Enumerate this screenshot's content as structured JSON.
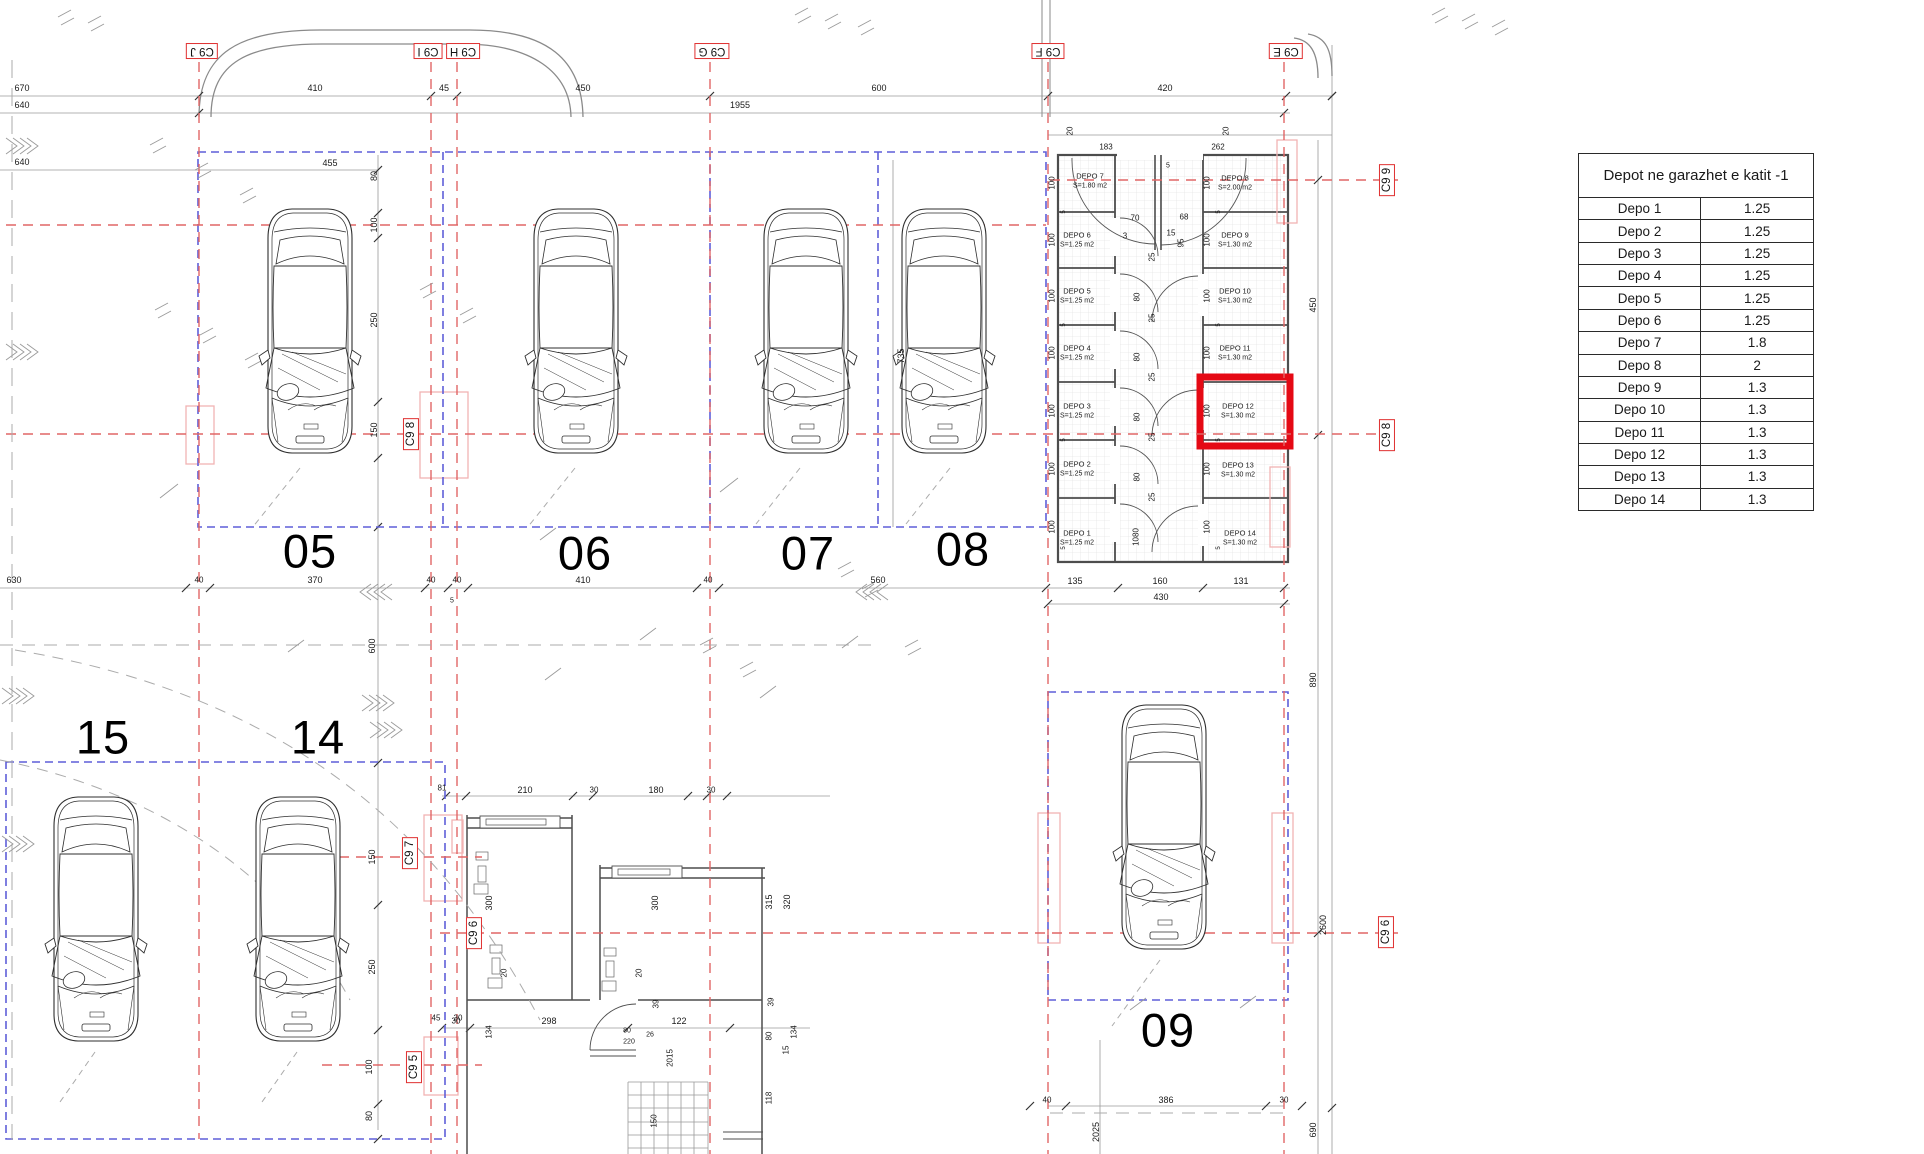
{
  "table": {
    "title": "Depot ne garazhet e katit -1",
    "rows": [
      {
        "name": "Depo 1",
        "value": "1.25"
      },
      {
        "name": "Depo 2",
        "value": "1.25"
      },
      {
        "name": "Depo 3",
        "value": "1.25"
      },
      {
        "name": "Depo 4",
        "value": "1.25"
      },
      {
        "name": "Depo 5",
        "value": "1.25"
      },
      {
        "name": "Depo 6",
        "value": "1.25"
      },
      {
        "name": "Depo 7",
        "value": "1.8"
      },
      {
        "name": "Depo 8",
        "value": "2"
      },
      {
        "name": "Depo 9",
        "value": "1.3"
      },
      {
        "name": "Depo 10",
        "value": "1.3"
      },
      {
        "name": "Depo 11",
        "value": "1.3"
      },
      {
        "name": "Depo 12",
        "value": "1.3"
      },
      {
        "name": "Depo 13",
        "value": "1.3"
      },
      {
        "name": "Depo 14",
        "value": "1.3"
      }
    ]
  },
  "grid_markers": [
    {
      "t": "C9 J",
      "x": 202,
      "y": 51,
      "r": 180
    },
    {
      "t": "C9 I",
      "x": 428,
      "y": 51,
      "r": 180
    },
    {
      "t": "C9 H",
      "x": 463,
      "y": 51,
      "r": 180
    },
    {
      "t": "C9 G",
      "x": 712,
      "y": 51,
      "r": 180
    },
    {
      "t": "C9 F",
      "x": 1048,
      "y": 51,
      "r": 180
    },
    {
      "t": "C9 E",
      "x": 1286,
      "y": 51,
      "r": 180
    },
    {
      "t": "C9 9",
      "x": 1387,
      "y": 180,
      "r": -90
    },
    {
      "t": "C9 8",
      "x": 411,
      "y": 434,
      "r": -90
    },
    {
      "t": "C9 8",
      "x": 1387,
      "y": 435,
      "r": -90
    },
    {
      "t": "C9 7",
      "x": 410,
      "y": 853,
      "r": -90
    },
    {
      "t": "C9 6",
      "x": 474,
      "y": 933,
      "r": -90
    },
    {
      "t": "C9 6",
      "x": 1386,
      "y": 932,
      "r": -90
    },
    {
      "t": "C9 5",
      "x": 414,
      "y": 1067,
      "r": -90
    }
  ],
  "stalls": [
    {
      "t": "05",
      "x": 310,
      "y": 551
    },
    {
      "t": "06",
      "x": 585,
      "y": 553
    },
    {
      "t": "07",
      "x": 808,
      "y": 553
    },
    {
      "t": "08",
      "x": 963,
      "y": 549
    },
    {
      "t": "09",
      "x": 1168,
      "y": 1030
    },
    {
      "t": "15",
      "x": 103,
      "y": 737
    },
    {
      "t": "14",
      "x": 318,
      "y": 737
    }
  ],
  "depots": [
    {
      "name": "DEPO 7",
      "area": "S=1.80 m2",
      "x": 1090,
      "y": 181
    },
    {
      "name": "DEPO 6",
      "area": "S=1.25 m2",
      "x": 1077,
      "y": 240
    },
    {
      "name": "DEPO 5",
      "area": "S=1.25 m2",
      "x": 1077,
      "y": 296
    },
    {
      "name": "DEPO 4",
      "area": "S=1.25 m2",
      "x": 1077,
      "y": 353
    },
    {
      "name": "DEPO 3",
      "area": "S=1.25 m2",
      "x": 1077,
      "y": 411
    },
    {
      "name": "DEPO 2",
      "area": "S=1.25 m2",
      "x": 1077,
      "y": 469
    },
    {
      "name": "DEPO 1",
      "area": "S=1.25 m2",
      "x": 1077,
      "y": 538
    },
    {
      "name": "DEPO 8",
      "area": "S=2.00 m2",
      "x": 1235,
      "y": 183
    },
    {
      "name": "DEPO 9",
      "area": "S=1.30 m2",
      "x": 1235,
      "y": 240
    },
    {
      "name": "DEPO 10",
      "area": "S=1.30 m2",
      "x": 1235,
      "y": 296
    },
    {
      "name": "DEPO 11",
      "area": "S=1.30 m2",
      "x": 1235,
      "y": 353
    },
    {
      "name": "DEPO 12",
      "area": "S=1.30 m2",
      "x": 1238,
      "y": 411
    },
    {
      "name": "DEPO 13",
      "area": "S=1.30 m2",
      "x": 1238,
      "y": 470
    },
    {
      "name": "DEPO 14",
      "area": "S=1.30 m2",
      "x": 1240,
      "y": 538
    }
  ],
  "dims": [
    {
      "t": "670",
      "x": 22,
      "y": 88
    },
    {
      "t": "640",
      "x": 22,
      "y": 105
    },
    {
      "t": "640",
      "x": 22,
      "y": 162
    },
    {
      "t": "410",
      "x": 315,
      "y": 88
    },
    {
      "t": "45",
      "x": 444,
      "y": 88
    },
    {
      "t": "450",
      "x": 583,
      "y": 88
    },
    {
      "t": "600",
      "x": 879,
      "y": 88
    },
    {
      "t": "420",
      "x": 1165,
      "y": 88
    },
    {
      "t": "1955",
      "x": 740,
      "y": 105
    },
    {
      "t": "183",
      "x": 1106,
      "y": 147,
      "fs": 8
    },
    {
      "t": "262",
      "x": 1218,
      "y": 147,
      "fs": 8
    },
    {
      "t": "20",
      "x": 1070,
      "y": 131,
      "r": -90,
      "fs": 8
    },
    {
      "t": "20",
      "x": 1226,
      "y": 131,
      "r": -90,
      "fs": 8
    },
    {
      "t": "5",
      "x": 1168,
      "y": 166,
      "fs": 7
    },
    {
      "t": "100",
      "x": 1052,
      "y": 183,
      "r": -90,
      "fs": 8
    },
    {
      "t": "100",
      "x": 1052,
      "y": 240,
      "r": -90,
      "fs": 8
    },
    {
      "t": "100",
      "x": 1052,
      "y": 296,
      "r": -90,
      "fs": 8
    },
    {
      "t": "100",
      "x": 1052,
      "y": 353,
      "r": -90,
      "fs": 8
    },
    {
      "t": "100",
      "x": 1052,
      "y": 411,
      "r": -90,
      "fs": 8
    },
    {
      "t": "100",
      "x": 1052,
      "y": 469,
      "r": -90,
      "fs": 8
    },
    {
      "t": "100",
      "x": 1052,
      "y": 527,
      "r": -90,
      "fs": 8
    },
    {
      "t": "5",
      "x": 1064,
      "y": 212,
      "r": -90,
      "fs": 6
    },
    {
      "t": "5",
      "x": 1064,
      "y": 325,
      "r": -90,
      "fs": 6
    },
    {
      "t": "5",
      "x": 1064,
      "y": 440,
      "r": -90,
      "fs": 6
    },
    {
      "t": "5",
      "x": 1064,
      "y": 548,
      "r": -90,
      "fs": 6
    },
    {
      "t": "100",
      "x": 1207,
      "y": 183,
      "r": -90,
      "fs": 8
    },
    {
      "t": "100",
      "x": 1207,
      "y": 240,
      "r": -90,
      "fs": 8
    },
    {
      "t": "100",
      "x": 1207,
      "y": 296,
      "r": -90,
      "fs": 8
    },
    {
      "t": "100",
      "x": 1207,
      "y": 353,
      "r": -90,
      "fs": 8
    },
    {
      "t": "100",
      "x": 1207,
      "y": 411,
      "r": -90,
      "fs": 8
    },
    {
      "t": "100",
      "x": 1207,
      "y": 469,
      "r": -90,
      "fs": 8
    },
    {
      "t": "100",
      "x": 1207,
      "y": 527,
      "r": -90,
      "fs": 8
    },
    {
      "t": "5",
      "x": 1219,
      "y": 212,
      "r": -90,
      "fs": 6
    },
    {
      "t": "5",
      "x": 1219,
      "y": 325,
      "r": -90,
      "fs": 6
    },
    {
      "t": "5",
      "x": 1219,
      "y": 440,
      "r": -90,
      "fs": 6
    },
    {
      "t": "5",
      "x": 1219,
      "y": 548,
      "r": -90,
      "fs": 6
    },
    {
      "t": "70",
      "x": 1135,
      "y": 218,
      "fs": 8
    },
    {
      "t": "3",
      "x": 1125,
      "y": 236,
      "fs": 8
    },
    {
      "t": "68",
      "x": 1184,
      "y": 217,
      "fs": 8
    },
    {
      "t": "15",
      "x": 1171,
      "y": 233,
      "fs": 8
    },
    {
      "t": "95",
      "x": 1181,
      "y": 243,
      "r": -90,
      "fs": 8
    },
    {
      "t": "25",
      "x": 1152,
      "y": 257,
      "r": -90,
      "fs": 8
    },
    {
      "t": "80",
      "x": 1137,
      "y": 297,
      "r": -90,
      "fs": 8
    },
    {
      "t": "25",
      "x": 1152,
      "y": 318,
      "r": -90,
      "fs": 8
    },
    {
      "t": "80",
      "x": 1137,
      "y": 357,
      "r": -90,
      "fs": 8
    },
    {
      "t": "25",
      "x": 1152,
      "y": 377,
      "r": -90,
      "fs": 8
    },
    {
      "t": "80",
      "x": 1137,
      "y": 417,
      "r": -90,
      "fs": 8
    },
    {
      "t": "25",
      "x": 1152,
      "y": 437,
      "r": -90,
      "fs": 8
    },
    {
      "t": "80",
      "x": 1137,
      "y": 477,
      "r": -90,
      "fs": 8
    },
    {
      "t": "25",
      "x": 1152,
      "y": 497,
      "r": -90,
      "fs": 8
    },
    {
      "t": "1080",
      "x": 1136,
      "y": 537,
      "r": -90,
      "fs": 8
    },
    {
      "t": "135",
      "x": 1075,
      "y": 581
    },
    {
      "t": "160",
      "x": 1160,
      "y": 581
    },
    {
      "t": "131",
      "x": 1241,
      "y": 581
    },
    {
      "t": "430",
      "x": 1161,
      "y": 597
    },
    {
      "t": "455",
      "x": 330,
      "y": 163
    },
    {
      "t": "80",
      "x": 374,
      "y": 176,
      "r": -90
    },
    {
      "t": "100",
      "x": 374,
      "y": 225,
      "r": -90
    },
    {
      "t": "250",
      "x": 374,
      "y": 320,
      "r": -90
    },
    {
      "t": "150",
      "x": 374,
      "y": 430,
      "r": -90
    },
    {
      "t": "735",
      "x": 901,
      "y": 356,
      "r": -90
    },
    {
      "t": "630",
      "x": 14,
      "y": 580
    },
    {
      "t": "40",
      "x": 199,
      "y": 580,
      "fs": 8
    },
    {
      "t": "370",
      "x": 315,
      "y": 580
    },
    {
      "t": "40",
      "x": 431,
      "y": 580,
      "fs": 8
    },
    {
      "t": "40",
      "x": 457,
      "y": 580,
      "fs": 8
    },
    {
      "t": "410",
      "x": 583,
      "y": 580
    },
    {
      "t": "40",
      "x": 708,
      "y": 580,
      "fs": 8
    },
    {
      "t": "560",
      "x": 878,
      "y": 580
    },
    {
      "t": "5",
      "x": 452,
      "y": 601,
      "fs": 7
    },
    {
      "t": "600",
      "x": 372,
      "y": 646,
      "r": -90
    },
    {
      "t": "150",
      "x": 372,
      "y": 857,
      "r": -90
    },
    {
      "t": "250",
      "x": 372,
      "y": 967,
      "r": -90
    },
    {
      "t": "100",
      "x": 369,
      "y": 1067,
      "r": -90
    },
    {
      "t": "80",
      "x": 369,
      "y": 1116,
      "r": -90
    },
    {
      "t": "81",
      "x": 442,
      "y": 788,
      "fs": 8
    },
    {
      "t": "45",
      "x": 436,
      "y": 1018,
      "fs": 8
    },
    {
      "t": "30",
      "x": 458,
      "y": 1018,
      "fs": 8
    },
    {
      "t": "210",
      "x": 525,
      "y": 790
    },
    {
      "t": "30",
      "x": 594,
      "y": 790,
      "fs": 8
    },
    {
      "t": "180",
      "x": 656,
      "y": 790
    },
    {
      "t": "30",
      "x": 711,
      "y": 790,
      "fs": 8
    },
    {
      "t": "300",
      "x": 489,
      "y": 903,
      "r": -90
    },
    {
      "t": "300",
      "x": 655,
      "y": 903,
      "r": -90
    },
    {
      "t": "315",
      "x": 769,
      "y": 902,
      "r": -90
    },
    {
      "t": "320",
      "x": 787,
      "y": 902,
      "r": -90
    },
    {
      "t": "20",
      "x": 504,
      "y": 973,
      "r": -90,
      "fs": 8
    },
    {
      "t": "20",
      "x": 639,
      "y": 973,
      "r": -90,
      "fs": 8
    },
    {
      "t": "30",
      "x": 456,
      "y": 1021,
      "fs": 8
    },
    {
      "t": "298",
      "x": 549,
      "y": 1021
    },
    {
      "t": "122",
      "x": 679,
      "y": 1021
    },
    {
      "t": "134",
      "x": 489,
      "y": 1032,
      "r": -90,
      "fs": 8
    },
    {
      "t": "39",
      "x": 656,
      "y": 1004,
      "r": -90,
      "fs": 8
    },
    {
      "t": "80",
      "x": 627,
      "y": 1031,
      "fs": 7
    },
    {
      "t": "220",
      "x": 629,
      "y": 1042,
      "fs": 7
    },
    {
      "t": "26",
      "x": 650,
      "y": 1035,
      "fs": 7
    },
    {
      "t": "2015",
      "x": 670,
      "y": 1058,
      "r": -90,
      "fs": 8
    },
    {
      "t": "150",
      "x": 654,
      "y": 1121,
      "r": -90,
      "fs": 8
    },
    {
      "t": "39",
      "x": 771,
      "y": 1002,
      "r": -90,
      "fs": 8
    },
    {
      "t": "80",
      "x": 769,
      "y": 1036,
      "r": -90,
      "fs": 8
    },
    {
      "t": "134",
      "x": 794,
      "y": 1032,
      "r": -90,
      "fs": 8
    },
    {
      "t": "15",
      "x": 786,
      "y": 1050,
      "r": -90,
      "fs": 8
    },
    {
      "t": "118",
      "x": 769,
      "y": 1098,
      "r": -90,
      "fs": 8
    },
    {
      "t": "40",
      "x": 1047,
      "y": 1100,
      "fs": 8
    },
    {
      "t": "386",
      "x": 1166,
      "y": 1100
    },
    {
      "t": "30",
      "x": 1284,
      "y": 1100,
      "fs": 8
    },
    {
      "t": "2025",
      "x": 1096,
      "y": 1132,
      "r": -90
    },
    {
      "t": "690",
      "x": 1313,
      "y": 1130,
      "r": -90
    },
    {
      "t": "2600",
      "x": 1323,
      "y": 925,
      "r": -90
    },
    {
      "t": "890",
      "x": 1313,
      "y": 680,
      "r": -90
    },
    {
      "t": "450",
      "x": 1313,
      "y": 305,
      "r": -90
    }
  ],
  "colors": {
    "grid_red": "#e06666",
    "boundary_blue": "#5f5fd8",
    "highlight_red": "#e50914",
    "column_pink": "#f2b3b3",
    "wall_gray": "#4d4d4d"
  }
}
